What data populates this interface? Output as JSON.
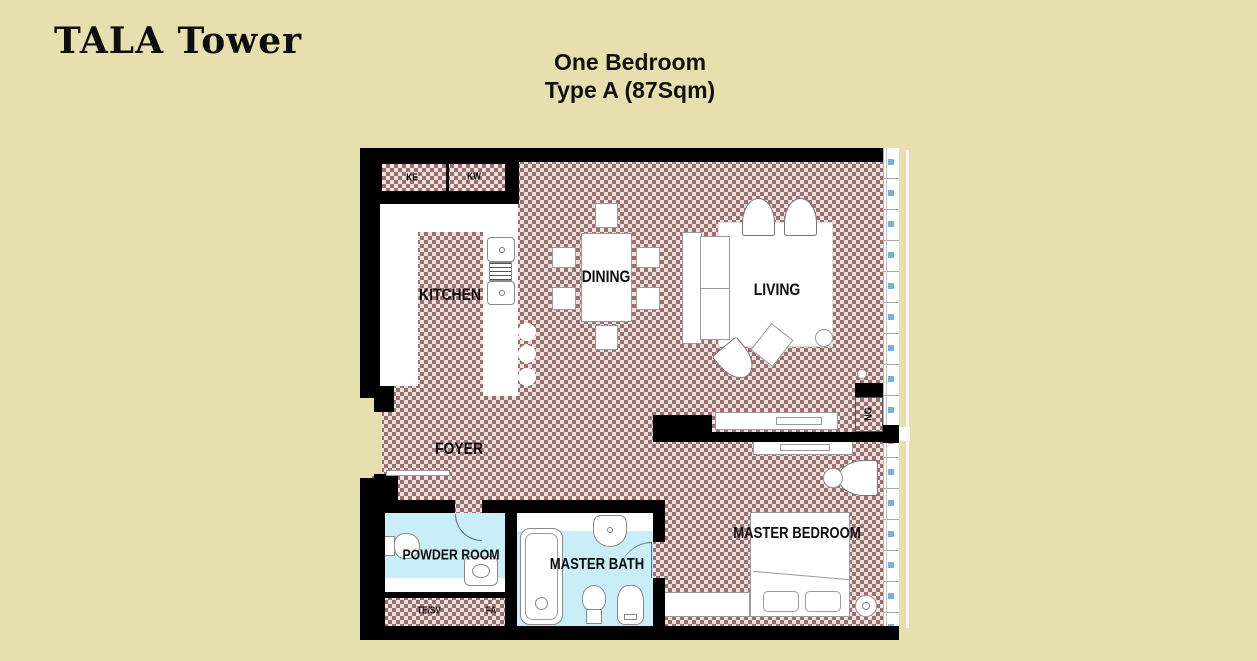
{
  "header": {
    "brand": "TALA Tower",
    "plan_title_line1": "One Bedroom",
    "plan_title_line2": "Type A (87Sqm)"
  },
  "floorplan": {
    "room_labels": {
      "kitchen": "KITCHEN",
      "dining": "DINING",
      "living": "LIVING",
      "foyer": "FOYER",
      "powder_room": "POWDER ROOM",
      "master_bath": "MASTER BATH",
      "master_bedroom": "MASTER BEDROOM"
    },
    "annotations": {
      "ke": "KE",
      "kw": "KW",
      "te_sv": "TE/SV",
      "fa": "FA",
      "ng": "NG"
    },
    "colors": {
      "page_background": "#e7e0ae",
      "wall": "#000000",
      "floor_checker": "#9c6e6e",
      "bath_floor": "#c9eef8",
      "window_tick": "#74b2d9"
    }
  }
}
